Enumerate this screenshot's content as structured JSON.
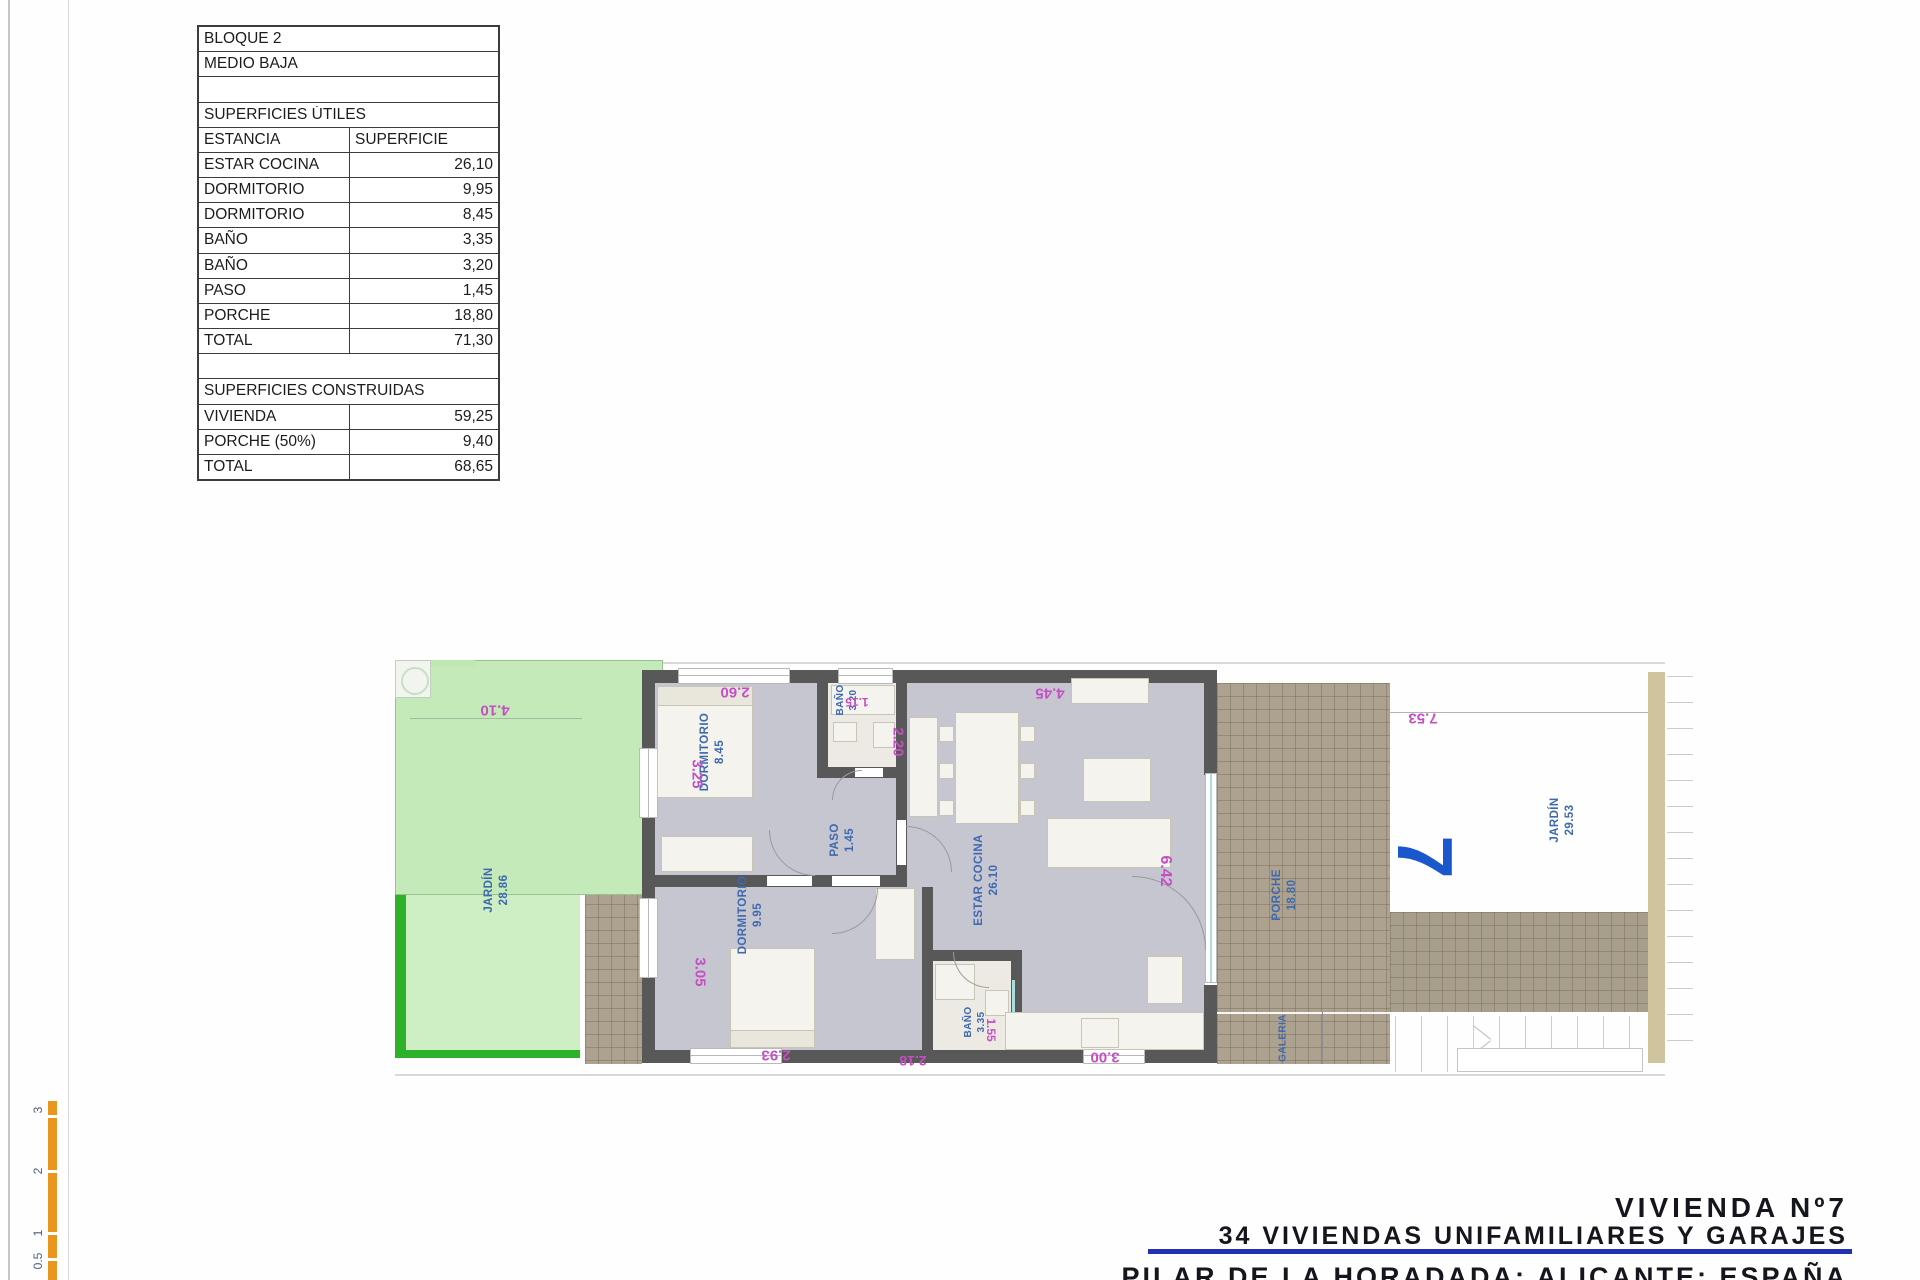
{
  "surface_table": {
    "title_rows": [
      "BLOQUE 2",
      "MEDIO BAJA"
    ],
    "section1_header": "SUPERFICIES ÚTILES",
    "columns": [
      "ESTANCIA",
      "SUPERFICIE"
    ],
    "section1_rows": [
      [
        "ESTAR COCINA",
        "26,10"
      ],
      [
        "DORMITORIO",
        "9,95"
      ],
      [
        "DORMITORIO",
        "8,45"
      ],
      [
        "BAÑO",
        "3,35"
      ],
      [
        "BAÑO",
        "3,20"
      ],
      [
        "PASO",
        "1,45"
      ],
      [
        "PORCHE",
        "18,80"
      ],
      [
        "TOTAL",
        "71,30"
      ]
    ],
    "section2_header": "SUPERFICIES CONSTRUIDAS",
    "section2_rows": [
      [
        "VIVIENDA",
        "59,25"
      ],
      [
        "PORCHE (50%)",
        "9,40"
      ],
      [
        "TOTAL",
        "68,65"
      ]
    ]
  },
  "floor_plan": {
    "unit_number": "7",
    "rooms": [
      {
        "id": "jardin-left",
        "name": "JARDÍN",
        "area": "28.86"
      },
      {
        "id": "dormitorio-1",
        "name": "DORMITORIO",
        "area": "8.45"
      },
      {
        "id": "bano-2",
        "name": "BAÑO",
        "area": "3.20"
      },
      {
        "id": "paso",
        "name": "PASO",
        "area": "1.45"
      },
      {
        "id": "dormitorio-2",
        "name": "DORMITORIO",
        "area": "9.95"
      },
      {
        "id": "bano-1",
        "name": "BAÑO",
        "area": "3.35"
      },
      {
        "id": "estar-cocina",
        "name": "ESTAR COCINA",
        "area": "26.10"
      },
      {
        "id": "porche",
        "name": "PORCHE",
        "area": "18.80"
      },
      {
        "id": "galeria",
        "name": "GALERIA",
        "area": ""
      },
      {
        "id": "jardin-right",
        "name": "JARDÍN",
        "area": "29.53"
      }
    ],
    "equipment": [
      {
        "id": "acs",
        "label": "ACS"
      }
    ],
    "dimensions": [
      "4.10",
      "2.60",
      "1.15",
      "3.25",
      "2.20",
      "4.45",
      "3.05",
      "2.93",
      "2.18",
      "1.55",
      "3.00",
      "6.42",
      "7.53"
    ]
  },
  "scale_bar": {
    "labels": [
      "3",
      "2",
      "1",
      "0.5"
    ]
  },
  "footer": {
    "line1": "VIVIENDA Nº7",
    "line2": "34 VIVIENDAS UNIFAMILIARES Y GARAJES",
    "line3": "PILAR DE LA HORADADA; ALICANTE; ESPAÑA"
  },
  "colors": {
    "garden_fill": "#cdefc3",
    "garden_border": "#2eb22a",
    "room_floor": "#c6c6d1",
    "wall": "#585858",
    "tile_paving": "#aca28f",
    "room_label_blue": "#3e68b0",
    "unit_number_blue": "#1b57cc",
    "dimension_magenta": "#c44fc4",
    "scale_bar_orange": "#e8961f",
    "footer_rule_blue": "#2230b2"
  }
}
